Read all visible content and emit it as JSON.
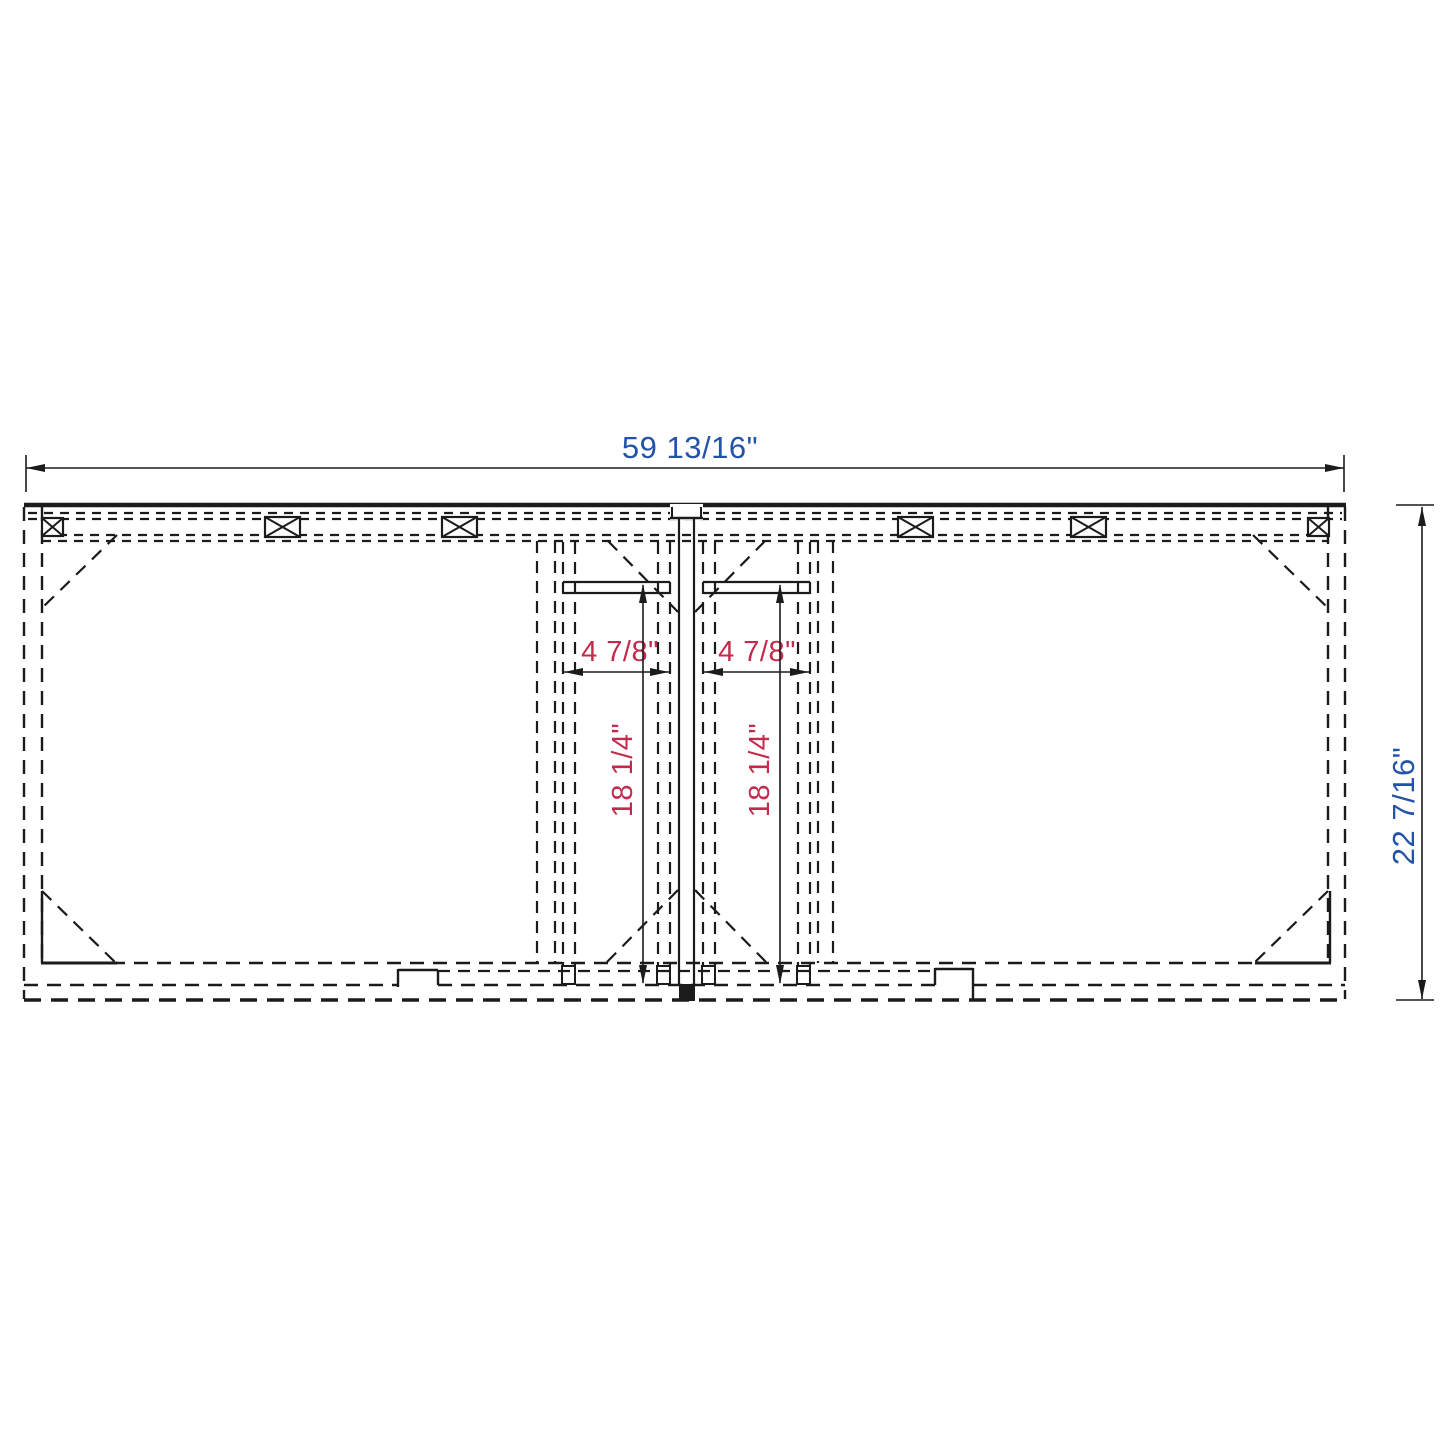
{
  "drawing": {
    "title": "double-sink vanity cabinet plan view",
    "colors": {
      "line": "#1b1b1b",
      "dimension_blue": "#2353a8",
      "dimension_red": "#c42a4c",
      "background": "#ffffff"
    },
    "dimensions": {
      "overall_width": "59 13/16\"",
      "overall_depth": "22 7/16\"",
      "left_opening_width": "4 7/8\"",
      "right_opening_width": "4 7/8\"",
      "left_opening_depth": "18 1/4\"",
      "right_opening_depth": "18 1/4\""
    }
  }
}
